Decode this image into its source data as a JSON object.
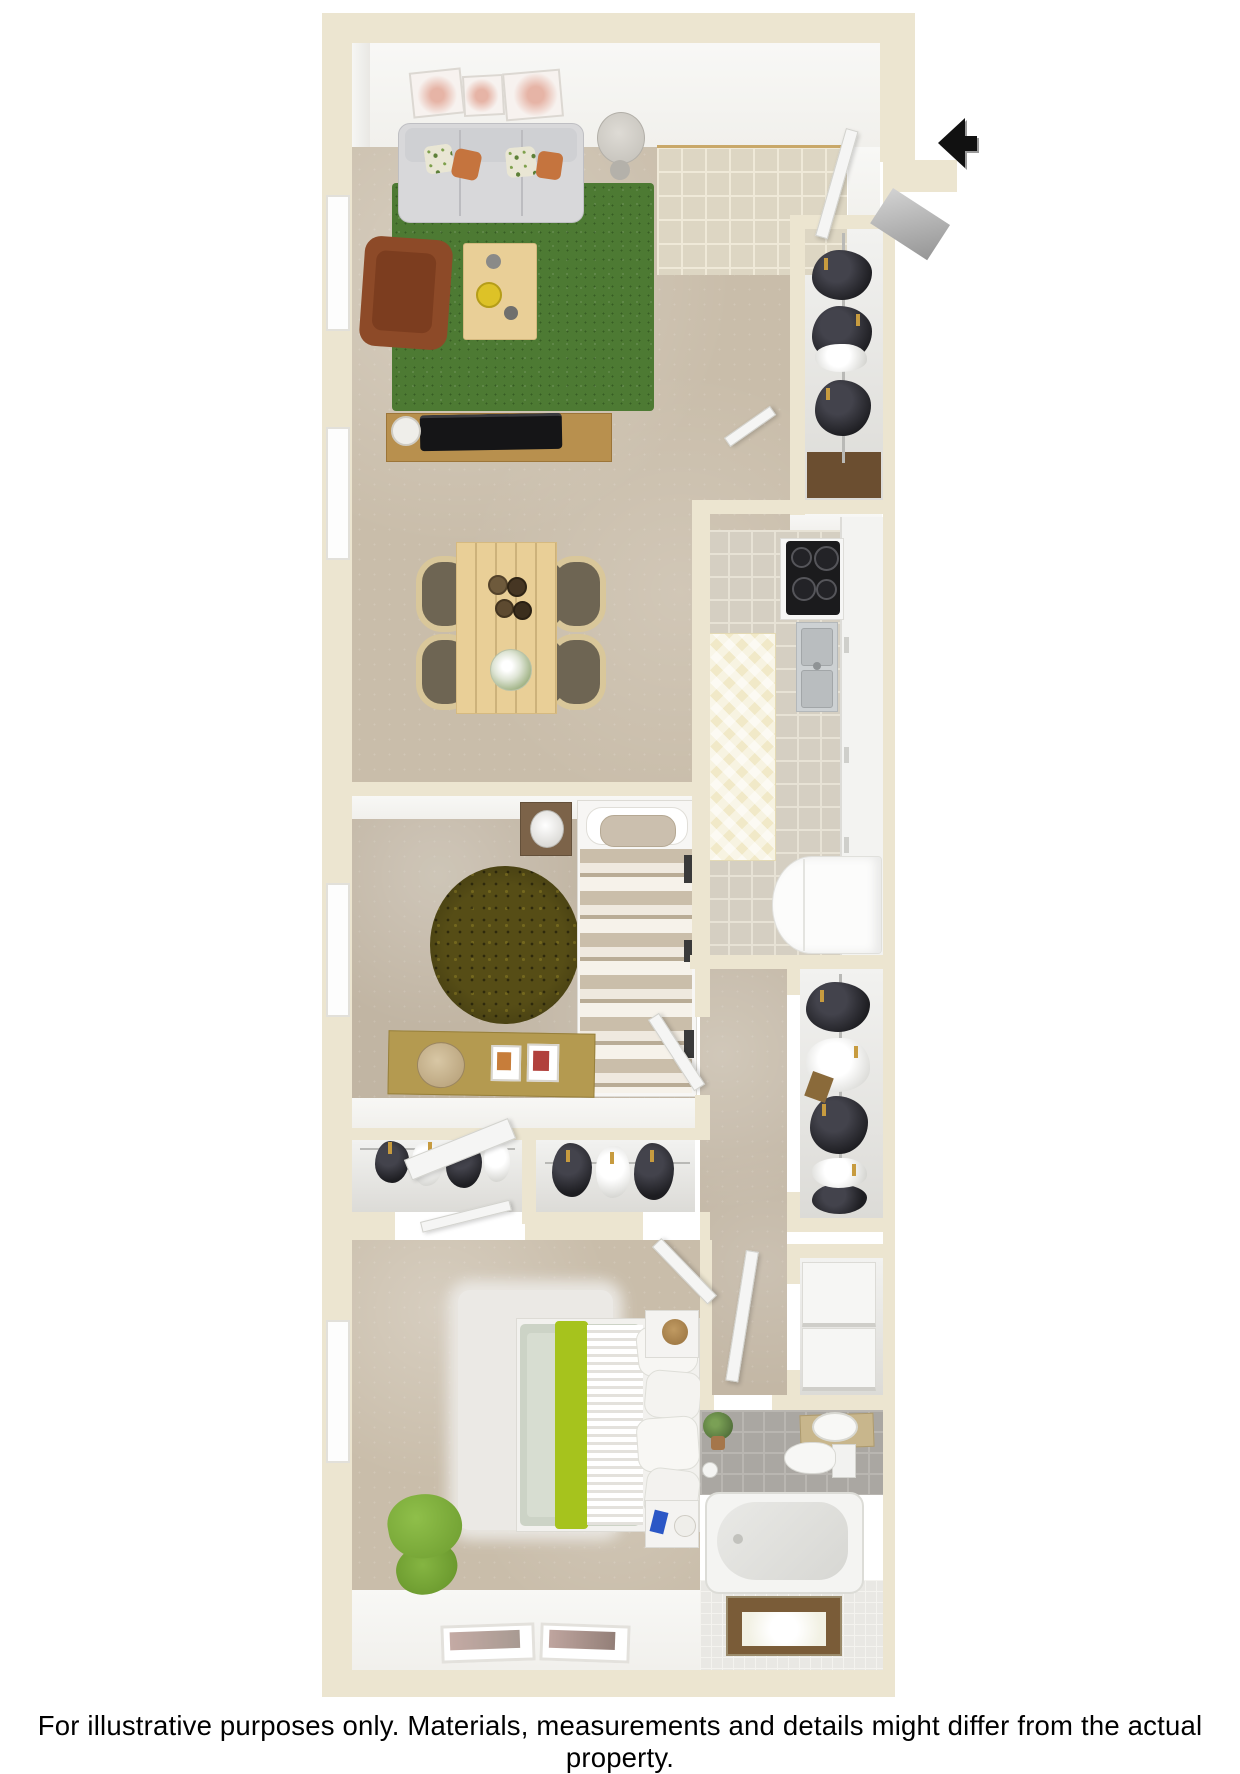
{
  "disclaimer": "For illustrative purposes only.  Materials, measurements and details might differ from the actual property.",
  "plan": {
    "view": "3D top-down apartment floor plan render",
    "entry_arrow_direction": "left",
    "rooms": [
      "entry",
      "living-room",
      "dining-area",
      "kitchen",
      "entry-closet",
      "bedroom-1",
      "closet-1",
      "closet-2",
      "hallway",
      "walk-in-closet",
      "linen-closet",
      "bedroom-2",
      "bathroom"
    ]
  },
  "colors": {
    "page_bg": "#ffffff",
    "wall_cream": "#ece5d0",
    "wall_face": "#f1f0ec",
    "carpet": "#c9bdaa",
    "tile_entry": "#ddd6c3",
    "tile_entry_line": "#efe9d8",
    "tile_kitchen": "#d5cfc2",
    "tile_kitchen_line": "#e7e2d5",
    "kitchen_runner": "#f1e9c8",
    "rug_green": "#4d7a33",
    "rug_olive": "#564d16",
    "rug_white": "#ebe9e5",
    "wood_light": "#e9cf97",
    "wood_mid": "#b8904e",
    "dresser_gold": "#b49a50",
    "nightstand_wood": "#7c6349",
    "sofa_gray": "#d8d8da",
    "pillow_orange": "#c5743e",
    "armchair_rust": "#8d4a28",
    "bed_stripe_tan": "#c9bda9",
    "bed_sage": "#ccd3c6",
    "bed_lime": "#a6c31d",
    "stove_black": "#1b1b1d",
    "steel": "#cdd1d3",
    "fridge_white": "#fcfcfb",
    "clothes_dark": "#1d1d21",
    "hanger_gold": "#c79b3f",
    "door_white": "#f5f5f4",
    "vanity_tan": "#c8b68c",
    "plant_green": "#5d7d42",
    "arrow_black": "#111111",
    "trim_gold": "#c9a869",
    "text_black": "#000000"
  }
}
